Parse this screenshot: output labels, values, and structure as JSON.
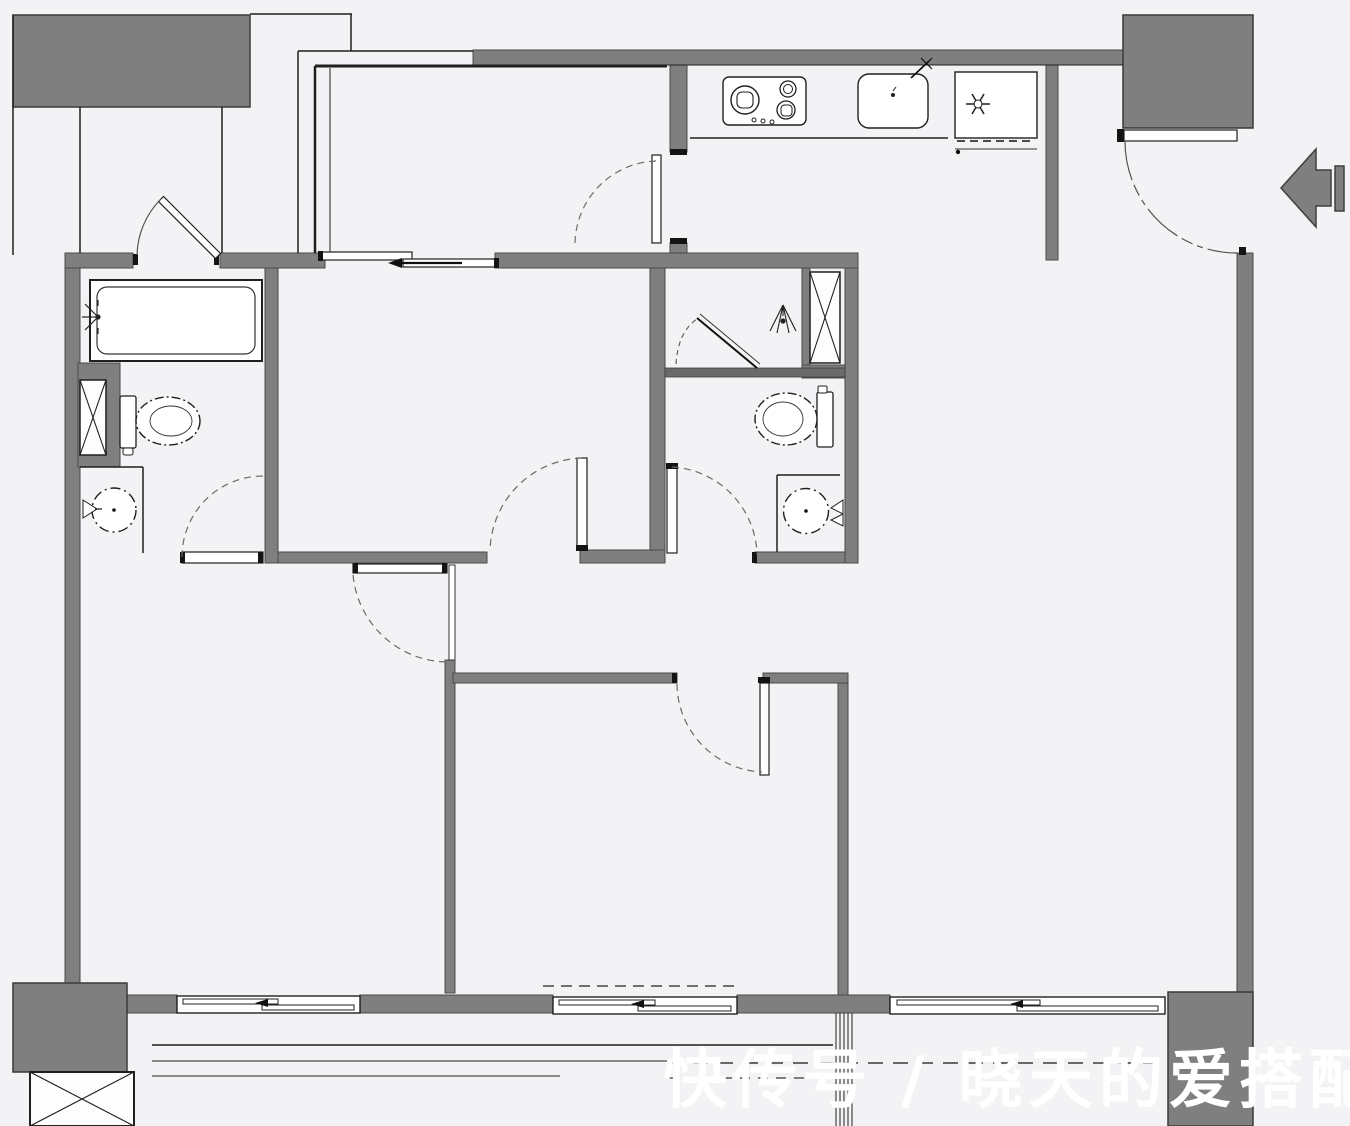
{
  "title": "apartment-floor-plan",
  "watermark": {
    "text": "快传号 / 晓天的爱搭配"
  },
  "colors": {
    "background": "#f3f3f5",
    "wall": "#7f7f7f",
    "wall_edge": "#4a4a4a",
    "line": "#1f1f1f",
    "soft": "#555555",
    "watermark": "#ffffff"
  },
  "entry": {
    "arrow_direction": "left"
  },
  "kitchen": {
    "fixtures": [
      "cooktop",
      "kitchen-sink",
      "refrigerator"
    ]
  },
  "bathroom_left": {
    "fixtures": [
      "bathtub",
      "shower-head",
      "toilet",
      "washbasin",
      "duct-shaft"
    ]
  },
  "bathroom_right": {
    "fixtures": [
      "shower-head",
      "shower-pivot-door",
      "toilet",
      "washbasin",
      "duct-shaft"
    ]
  },
  "balcony": {
    "fixtures": [
      "duct-shaft",
      "railing-lines",
      "drain-pipes"
    ]
  },
  "counts": {
    "hinged_doors": 8,
    "sliding_doors": 1,
    "sliding_windows": 3,
    "duct_shafts": 3
  }
}
